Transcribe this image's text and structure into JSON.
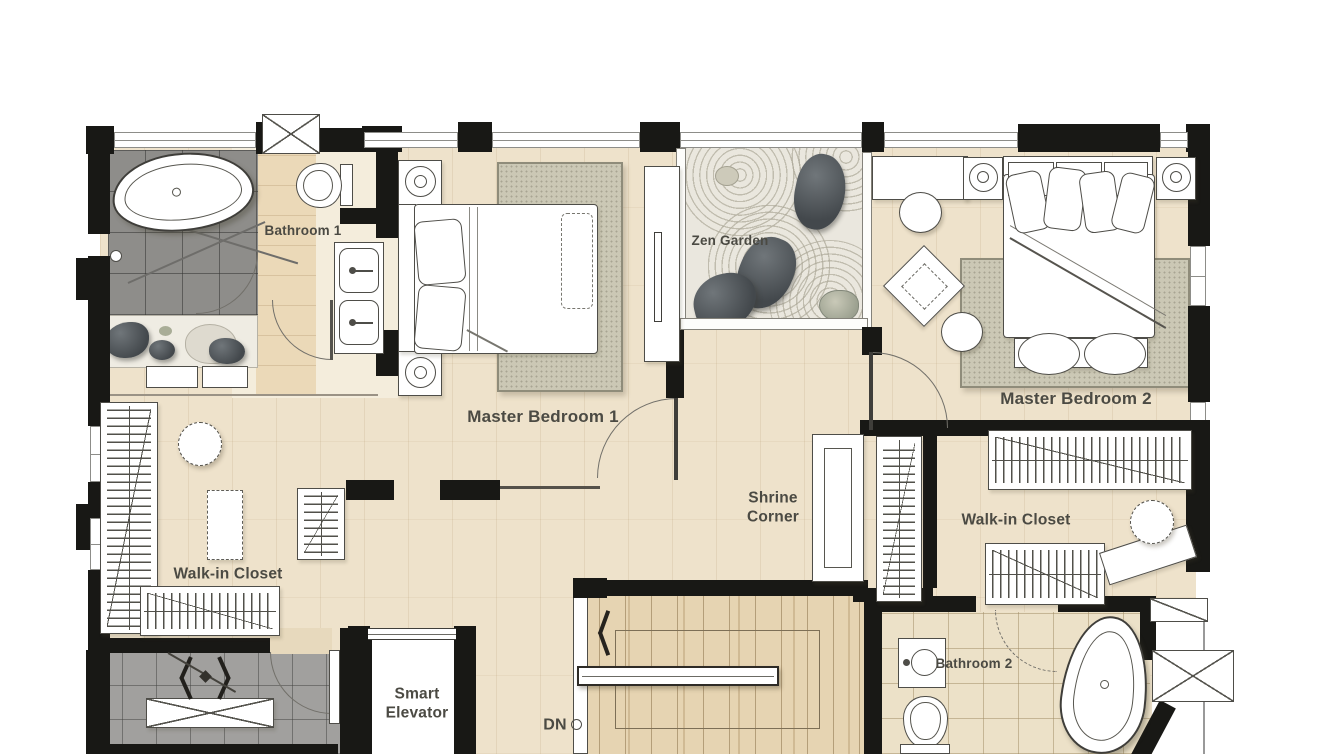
{
  "meta": {
    "type": "residential-floor-plan",
    "view": "top-down"
  },
  "rooms": {
    "bathroom1": {
      "label": "Bathroom 1"
    },
    "zen_garden": {
      "label": "Zen Garden"
    },
    "master_bedroom1": {
      "label": "Master Bedroom 1"
    },
    "master_bedroom2": {
      "label": "Master Bedroom 2"
    },
    "shrine_corner": {
      "label": "Shrine Corner"
    },
    "walk_in_closet_left": {
      "label": "Walk-in Closet"
    },
    "walk_in_closet_right": {
      "label": "Walk-in Closet"
    },
    "smart_elevator": {
      "label": "Smart Elevator"
    },
    "bathroom2": {
      "label": "Bathroom 2"
    },
    "stairs": {
      "label": "DN"
    }
  },
  "colors": {
    "wall": "#181815",
    "wood_floor": "#eee2cb",
    "stair_wood": "#e6d4b2",
    "dark_tile": "#8e8d8a",
    "gray_tile": "#a1a09e",
    "zen_sand": "#eae7de",
    "rug": "#cbc8b5",
    "bathroom2_tile": "#ece1c8",
    "label_text": "#4b4a43"
  }
}
